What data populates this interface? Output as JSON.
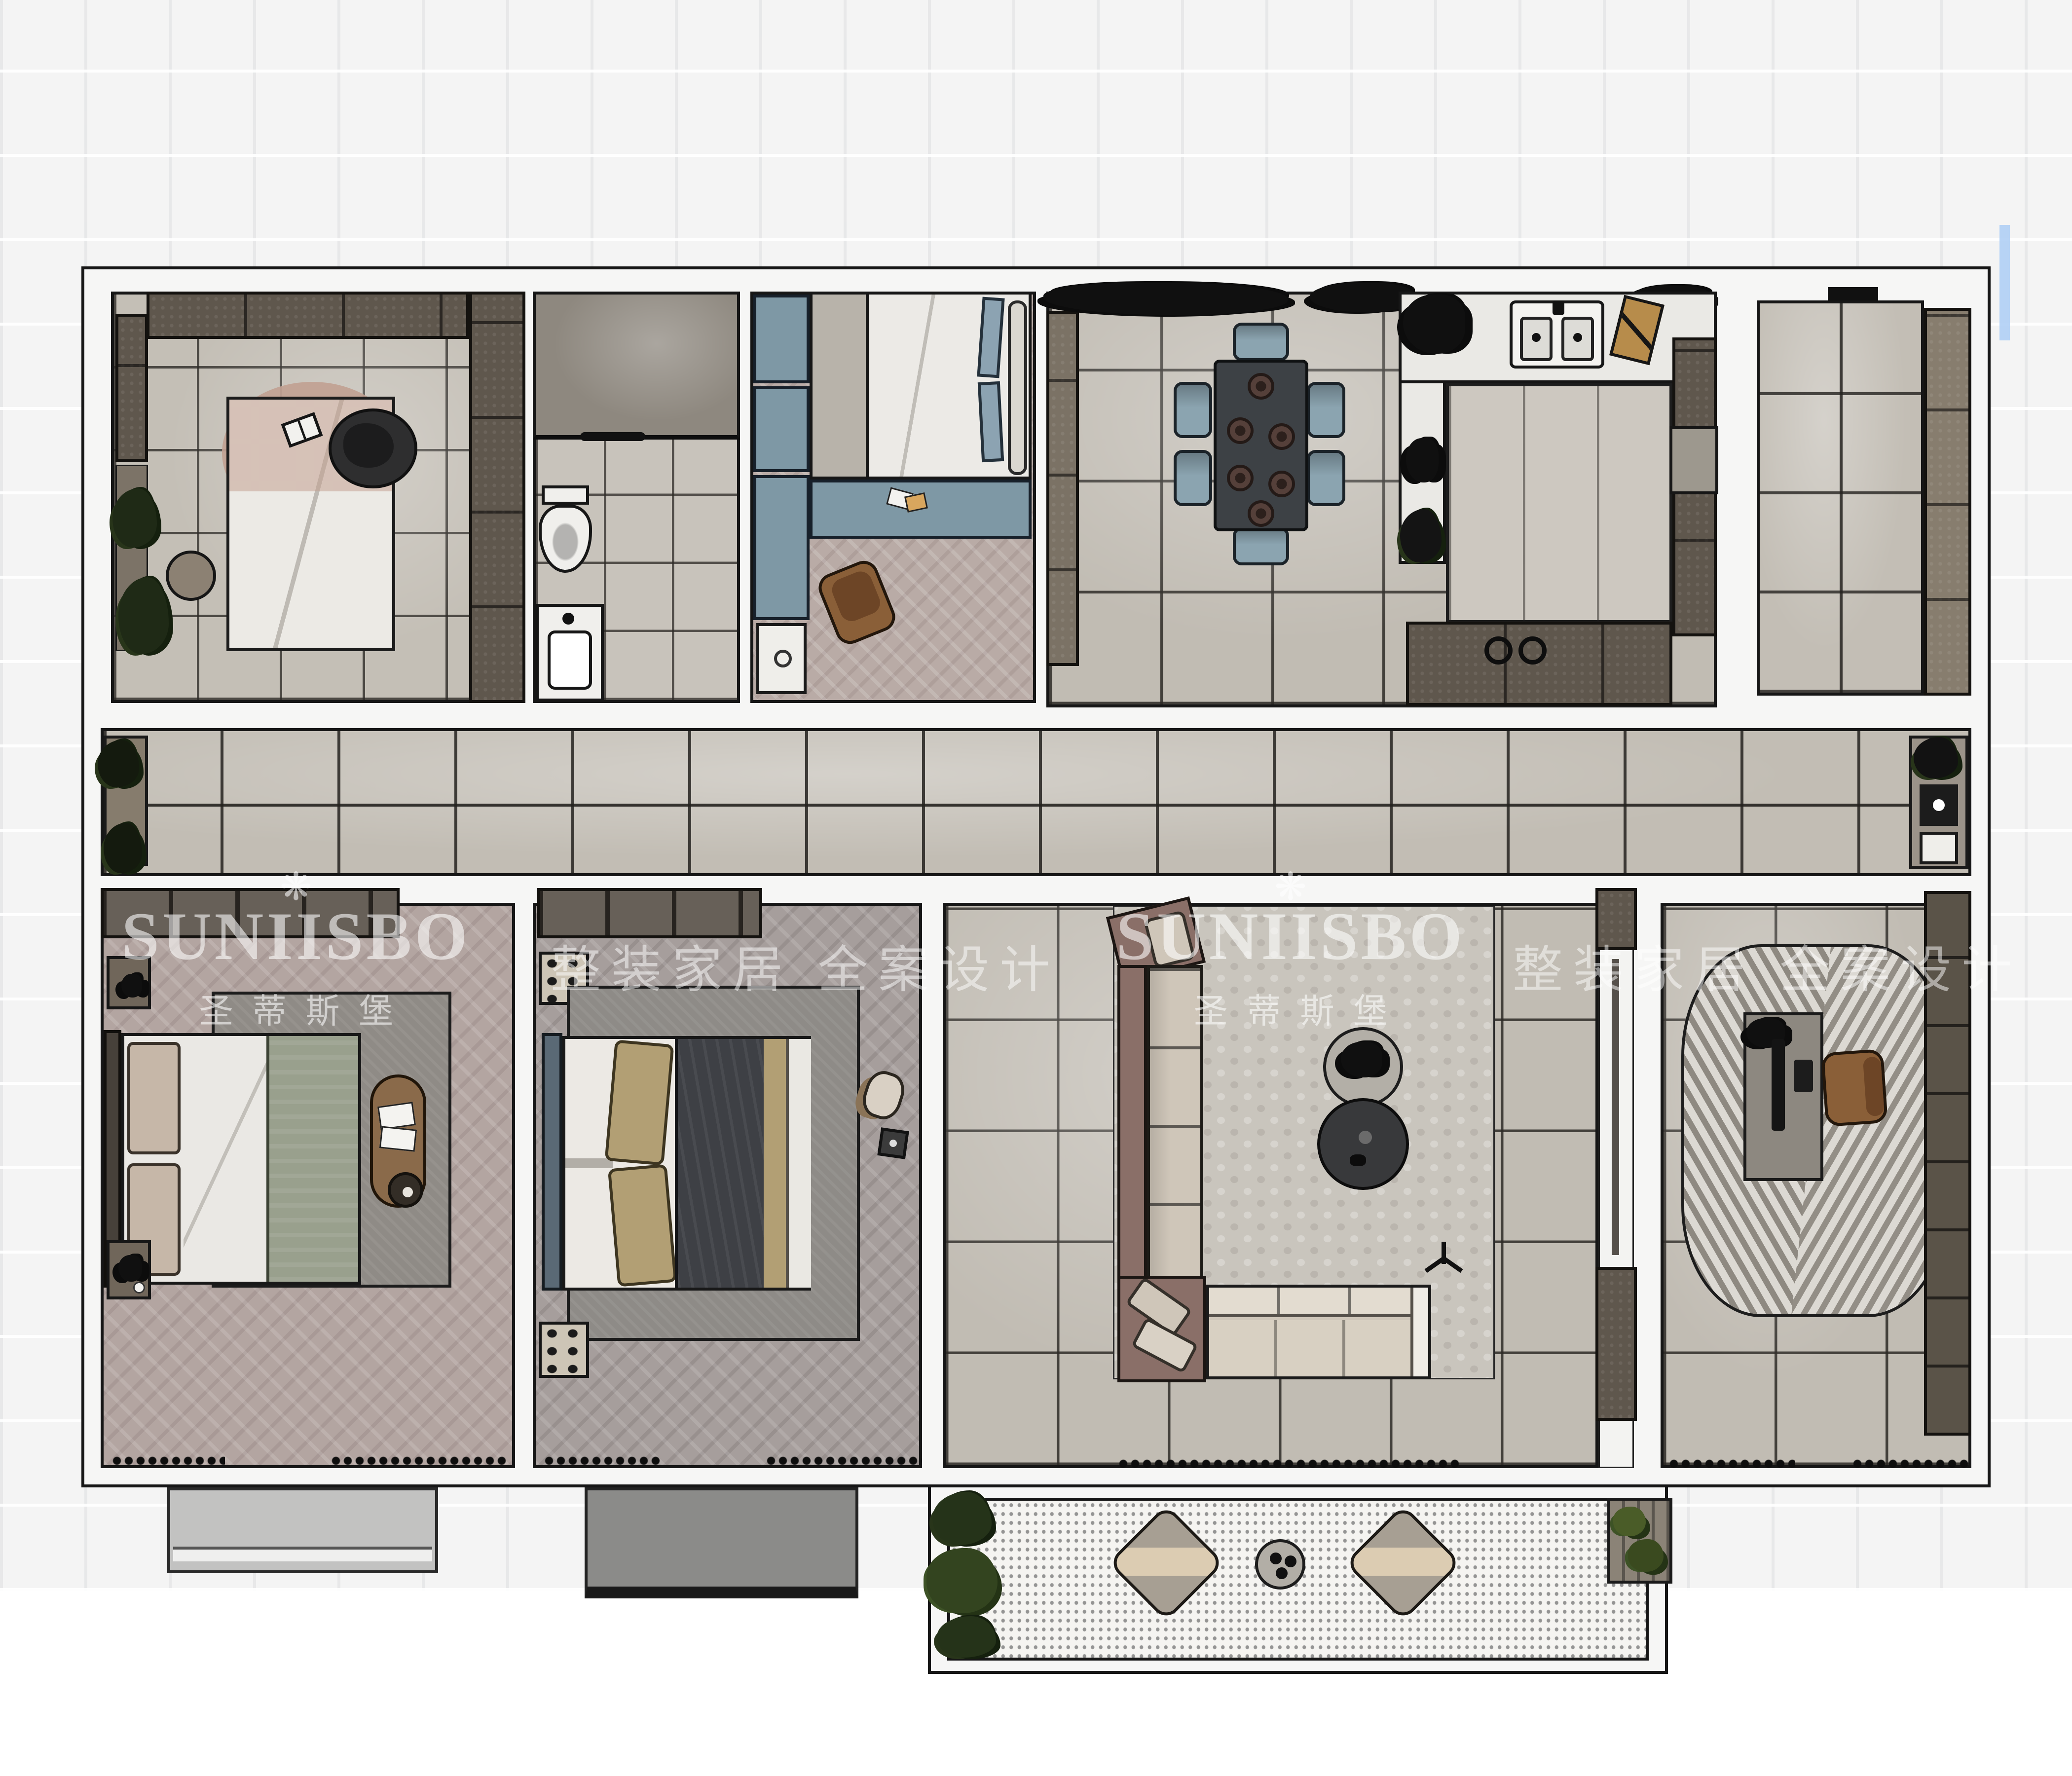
{
  "watermarks": {
    "brand_logo_glyph": "❋",
    "brand_name": "SUNIISBO",
    "brand_name_cn": "圣蒂斯堡",
    "slogan": "整装家居 全案设计"
  },
  "palette": {
    "page_background": "#ffffff",
    "background_tile": "#f4f4f4",
    "wall_fill": "#f6f6f5",
    "wall_outline": "#161616",
    "floor_tile_gray": "#c1bcb3",
    "floor_herringbone_pink": "#b3a5a1",
    "floor_herringbone_gray": "#a69e9c",
    "cabinet_dark_brown": "#5f574d",
    "furniture_blue_gray": "#7e98a5",
    "dining_table_charcoal": "#3d4145",
    "leather_chair_brown": "#8a5f38",
    "sofa_mauve": "#8a6f68",
    "cushion_beige": "#cfc6b9",
    "blanket_sage_green": "#99a08d",
    "blanket_navy": "#3e4045",
    "rug_gray": "#8f8b86",
    "balcony_dot_floor": "#f5f4f1",
    "plant_green_dark": "#1f2a16",
    "watermark_white": "rgba(255,255,255,0.55)",
    "edge_artifact_blue": "#abcdf4"
  }
}
